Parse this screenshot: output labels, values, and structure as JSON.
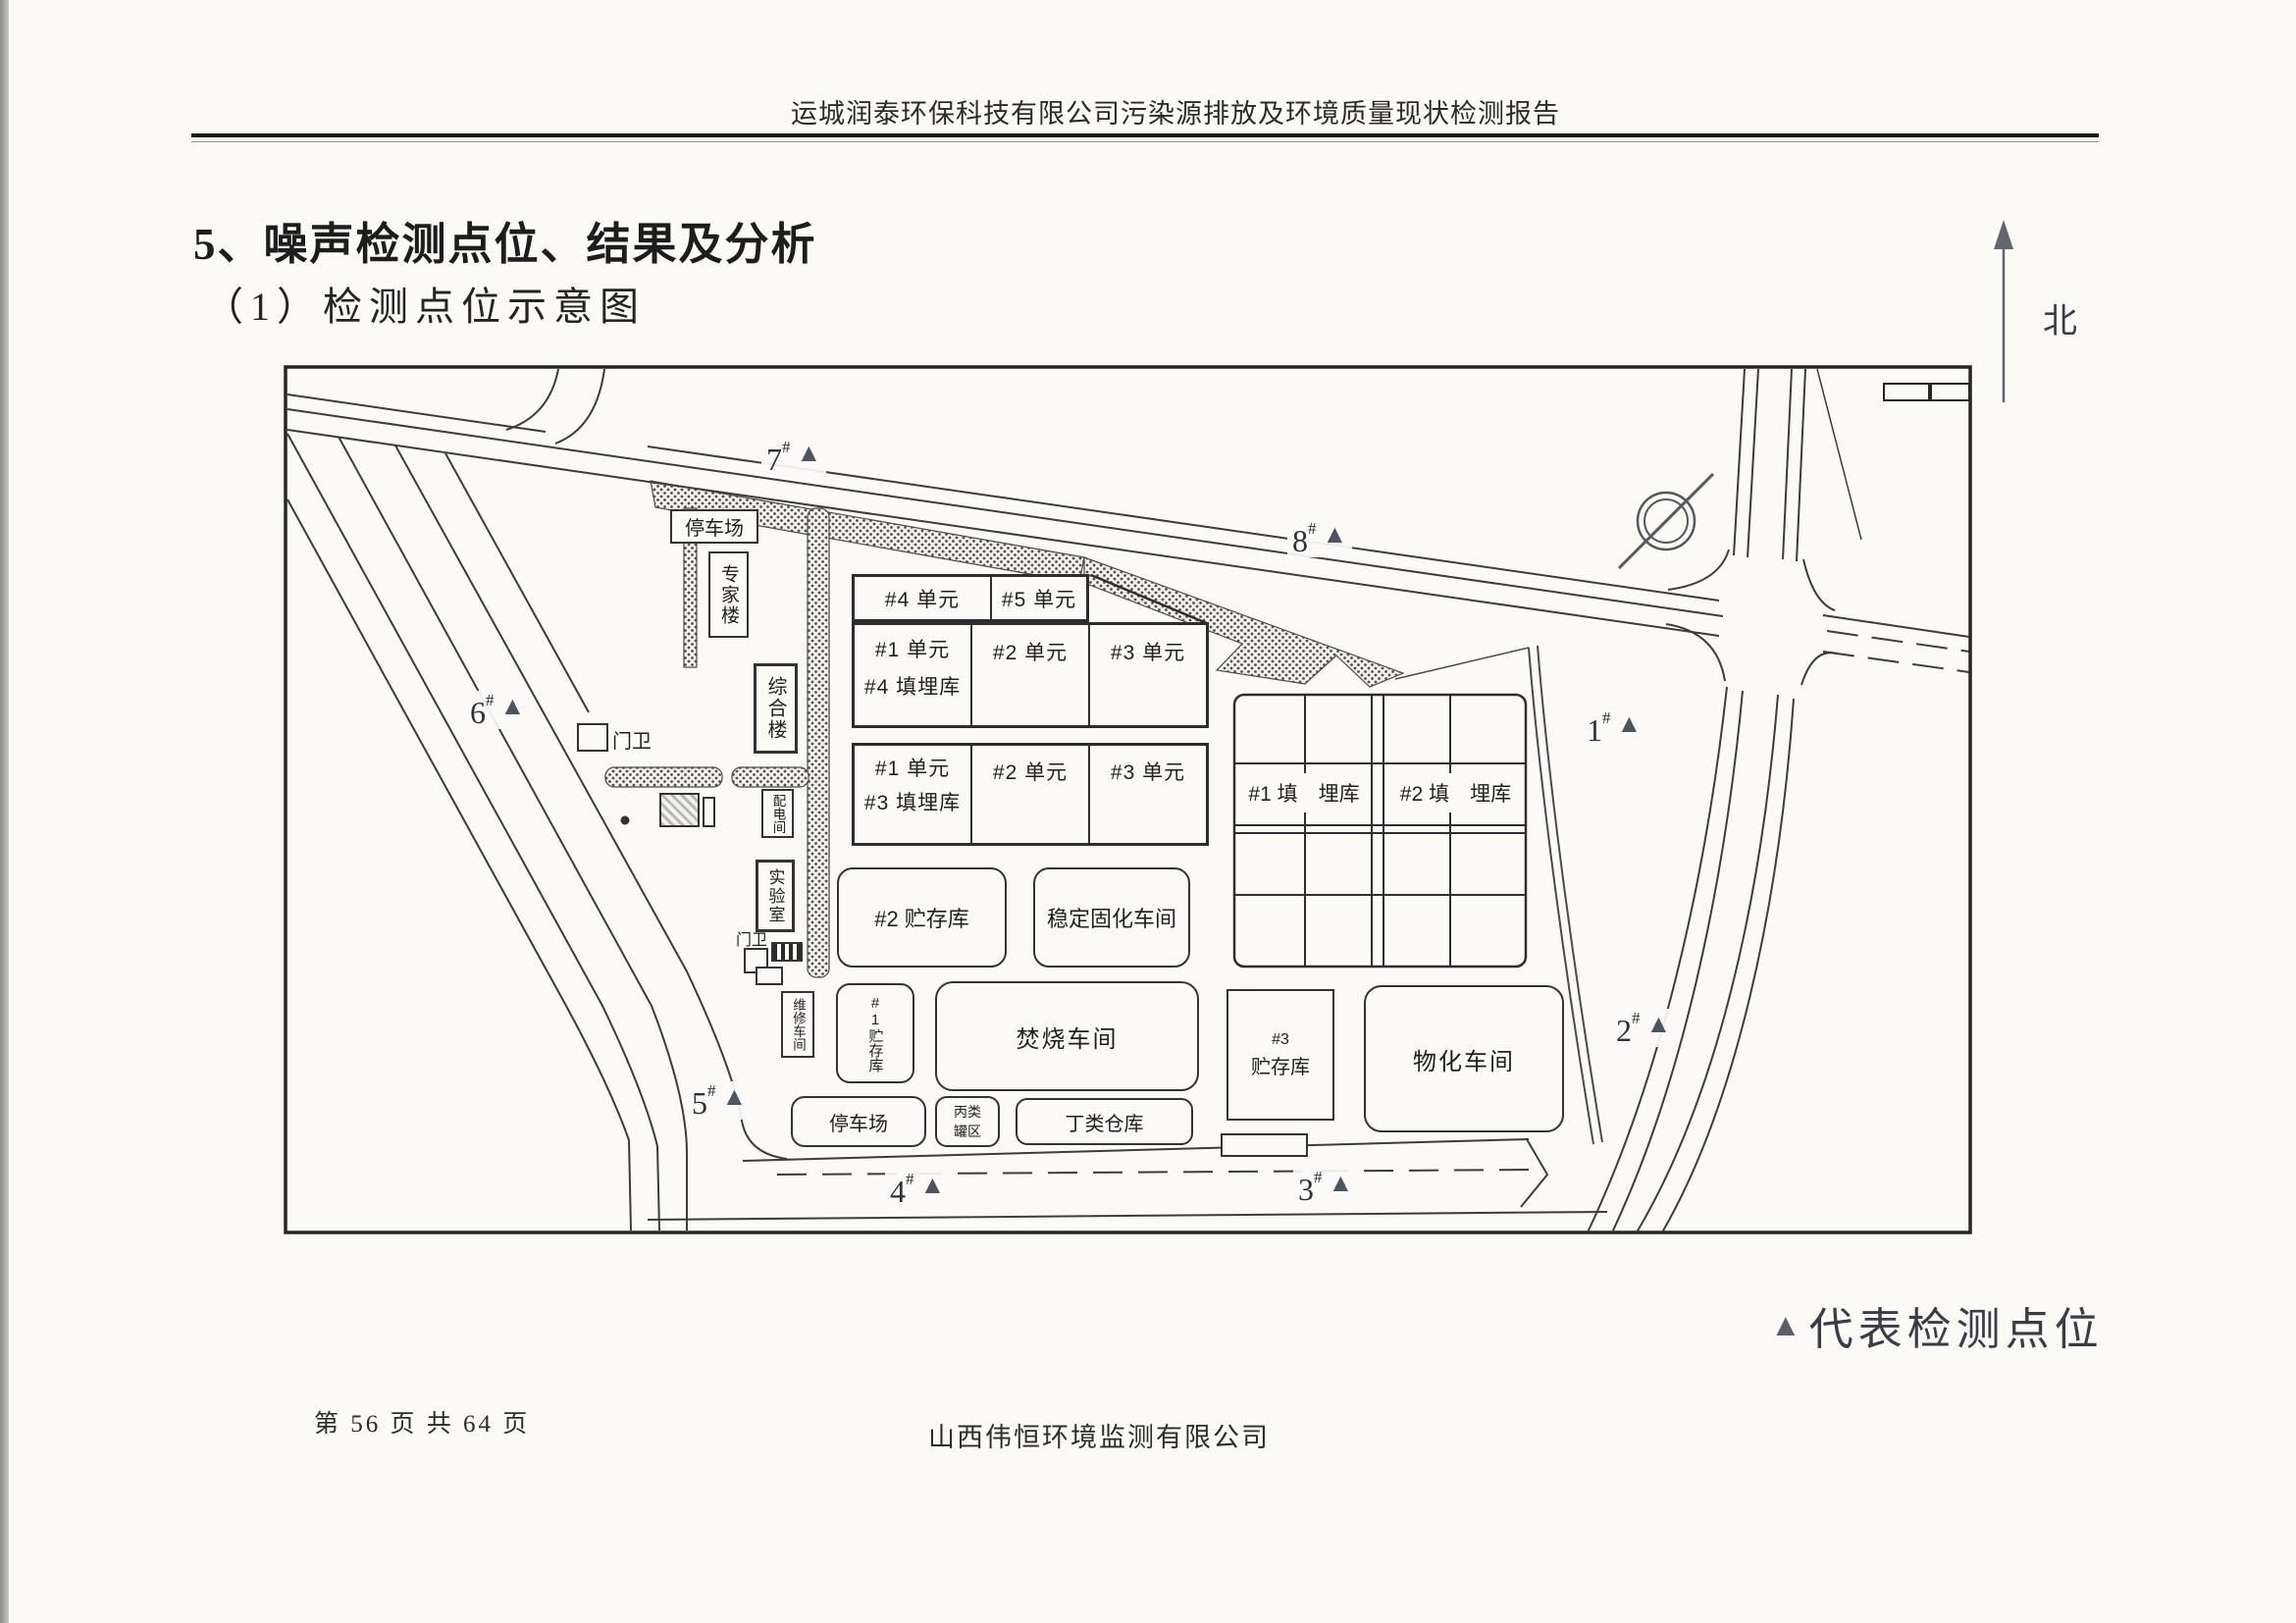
{
  "colors": {
    "paper": "#fbfaf7",
    "ink": "#262626",
    "line": "#3c3c3c",
    "marker_triangle": "#4e5460"
  },
  "header": {
    "report_title": "运城润泰环保科技有限公司污染源排放及环境质量现状检测报告"
  },
  "headings": {
    "section": "5、噪声检测点位、结果及分析",
    "subsection": "（1）检测点位示意图"
  },
  "compass": {
    "north_label": "北"
  },
  "legend": {
    "symbol": "▲",
    "text": "代表检测点位"
  },
  "footer": {
    "page_info": "第 56 页 共 64 页",
    "company": "山西伟恒环境监测有限公司"
  },
  "diagram": {
    "point_hash": "#",
    "marker_symbol": "▲",
    "points": [
      "1",
      "2",
      "3",
      "4",
      "5",
      "6",
      "7",
      "8"
    ],
    "buildings": {
      "parking_top": "停车场",
      "expert": "专家楼",
      "complex": "综合楼",
      "power": "配电间",
      "lab": "实验室",
      "maintenance": "维修车间",
      "gate1": "门卫",
      "gate2": "门卫",
      "unit4": "#4 单元",
      "unit5": "#5 单元",
      "r2c1a": "#1 单元",
      "r2c1b": "#4 填埋库",
      "r2c2": "#2 单元",
      "r2c3": "#3 单元",
      "r3c1a": "#1 单元",
      "r3c1b": "#3 填埋库",
      "r3c2": "#2 单元",
      "r3c3": "#3 单元",
      "landfill1": "#1 填　埋库",
      "landfill2": "#2 填　埋库",
      "storage1": "#1贮存库",
      "storage2": "#2 贮存库",
      "storage3a": "#3",
      "storage3b": "贮存库",
      "solidify": "稳定固化车间",
      "incinerate": "焚烧车间",
      "physchem": "物化车间",
      "parking_bottom": "停车场",
      "tank_a": "丙类",
      "tank_b": "罐区",
      "warehouse_d": "丁类仓库"
    }
  }
}
